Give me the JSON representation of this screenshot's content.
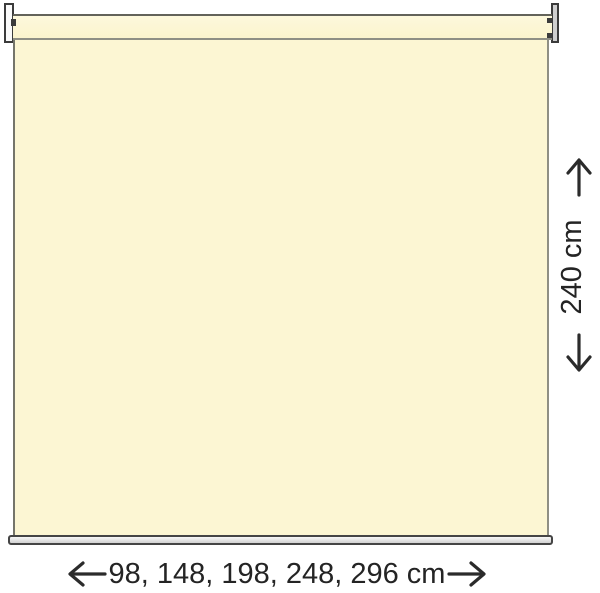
{
  "diagram": {
    "name": "Roller blind dimension diagram",
    "product": "roller-blind",
    "height_dimension": {
      "label": "240 cm"
    },
    "width_dimension": {
      "label": "98, 148, 198, 248, 296 cm"
    },
    "colors": {
      "fabric": "#FCF6D3",
      "outline_dark": "#3B3B3B",
      "roller_line_top": "#63635A",
      "roller_line_bottom": "#8F8F84",
      "bottom_bar_fill": "#E4E4E4",
      "arrow_and_text": "#242424",
      "background": "#FFFFFF"
    }
  }
}
